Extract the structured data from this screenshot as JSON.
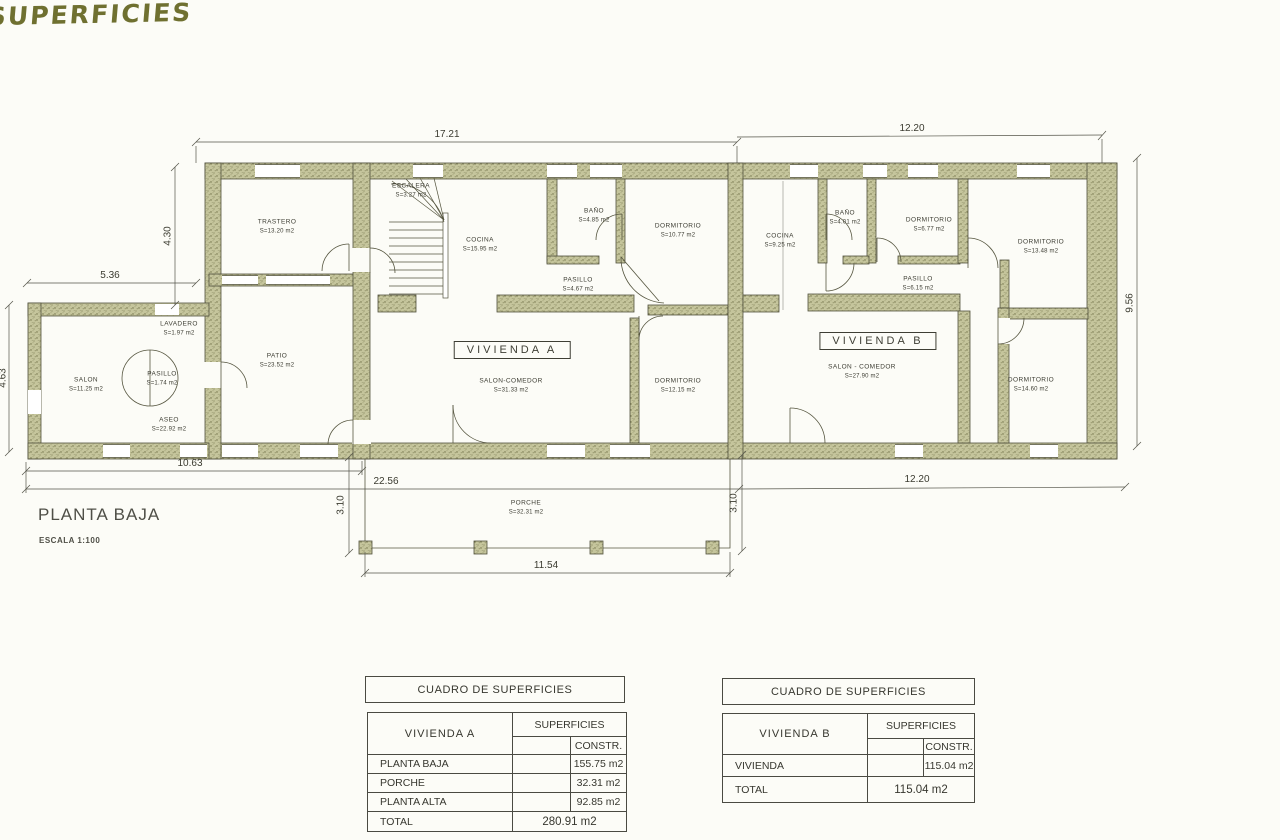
{
  "sheet": {
    "handwritten_title": "SUPERFICIES",
    "plan_title": "PLANTA BAJA",
    "plan_scale": "ESCALA 1:100",
    "colors": {
      "paper": "#fcfcf7",
      "wall_fill": "#c5c59c",
      "wall_speckle": "#6e6e46",
      "line": "#50503c",
      "handwriting": "#6f7030",
      "text": "#3b3b30"
    }
  },
  "plan": {
    "vivienda_a_label": "VIVIENDA A",
    "vivienda_b_label": "VIVIENDA B",
    "rooms": {
      "trastero": {
        "name": "TRASTERO",
        "area": "S=13.20 m2"
      },
      "escalera": {
        "name": "ESCALERA",
        "area": "S=3.27 m2"
      },
      "cocina_a": {
        "name": "COCINA",
        "area": "S=15.95 m2"
      },
      "bano_a": {
        "name": "BAÑO",
        "area": "S=4.85 m2"
      },
      "dormitorio_a1": {
        "name": "DORMITORIO",
        "area": "S=10.77 m2"
      },
      "pasillo_a": {
        "name": "PASILLO",
        "area": "S=4.67 m2"
      },
      "salon_comedor_a": {
        "name": "SALON-COMEDOR",
        "area": "S=31.33 m2"
      },
      "dormitorio_a2": {
        "name": "DORMITORIO",
        "area": "S=12.15 m2"
      },
      "cocina_b": {
        "name": "COCINA",
        "area": "S=9.25 m2"
      },
      "bano_b": {
        "name": "BAÑO",
        "area": "S=4.01 m2"
      },
      "dormitorio_b1": {
        "name": "DORMITORIO",
        "area": "S=6.77 m2"
      },
      "pasillo_b": {
        "name": "PASILLO",
        "area": "S=6.15 m2"
      },
      "dormitorio_b2": {
        "name": "DORMITORIO",
        "area": "S=13.48 m2"
      },
      "salon_comedor_b": {
        "name": "SALON - COMEDOR",
        "area": "S=27.90 m2"
      },
      "dormitorio_b3": {
        "name": "DORMITORIO",
        "area": "S=14.60 m2"
      },
      "lavadero": {
        "name": "LAVADERO",
        "area": "S=1.97 m2"
      },
      "salon": {
        "name": "SALON",
        "area": "S=11.25 m2"
      },
      "pasillo_annex": {
        "name": "PASILLO",
        "area": "S=1.74 m2"
      },
      "aseo": {
        "name": "ASEO",
        "area": "S=22.92 m2"
      },
      "patio": {
        "name": "PATIO",
        "area": "S=23.52 m2"
      },
      "porche": {
        "name": "PORCHE",
        "area": "S=32.31 m2"
      }
    },
    "dimensions": {
      "top_left": "17.21",
      "top_right": "12.20",
      "left_upper": "4.30",
      "left_mid": "5.36",
      "left_lower": "4.63",
      "right_side": "9.56",
      "bottom_annex": "10.63",
      "bottom_total": "22.56",
      "bottom_right": "12.20",
      "porche_depth_left": "3.10",
      "porche_depth_right": "3.10",
      "porche_width": "11.54"
    }
  },
  "tables": {
    "vivienda_a": {
      "header": "CUADRO DE SUPERFICIES",
      "row_header": "VIVIENDA A",
      "col_group": "SUPERFICIES",
      "col_sub": "CONSTR.",
      "rows": [
        {
          "label": "PLANTA BAJA",
          "value": "155.75 m2"
        },
        {
          "label": "PORCHE",
          "value": "32.31 m2"
        },
        {
          "label": "PLANTA ALTA",
          "value": "92.85 m2"
        }
      ],
      "total_label": "TOTAL",
      "total_value": "280.91 m2"
    },
    "vivienda_b": {
      "header": "CUADRO DE SUPERFICIES",
      "row_header": "VIVIENDA B",
      "col_group": "SUPERFICIES",
      "col_sub": "CONSTR.",
      "rows": [
        {
          "label": "VIVIENDA",
          "value": "115.04 m2"
        }
      ],
      "total_label": "TOTAL",
      "total_value": "115.04 m2"
    }
  }
}
